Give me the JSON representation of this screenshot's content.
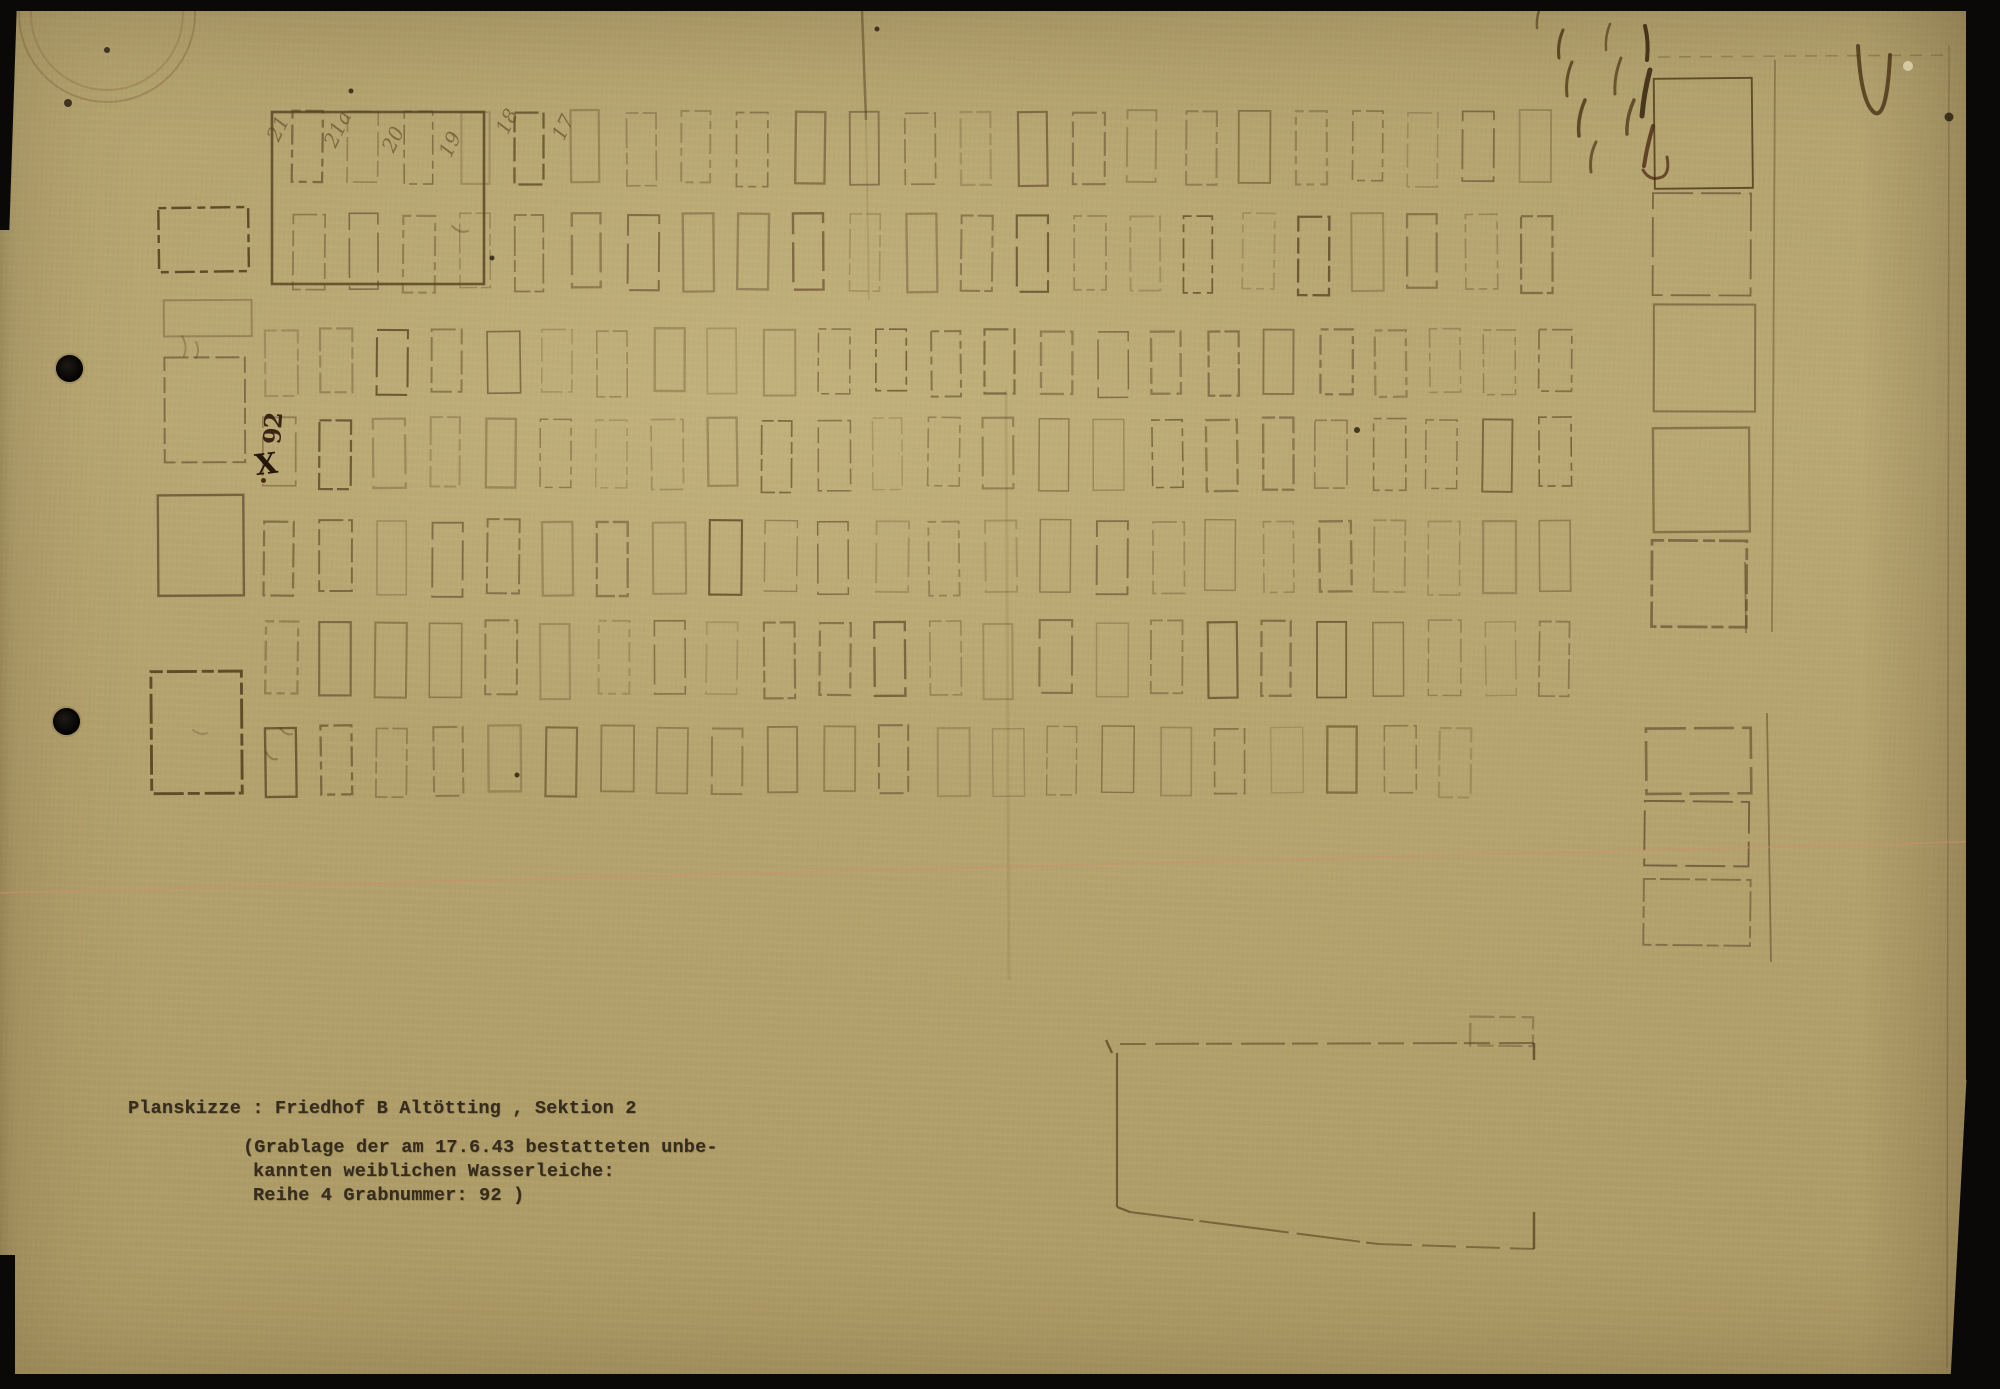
{
  "document_type": "scanned archival plan sketch",
  "caption": {
    "title": "Planskizze : Friedhof B Altötting , Sektion 2",
    "note_line1": "(Grablage der am 17.6.43 bestatteten unbe-",
    "note_line2": "kannten weiblichen Wasserleiche:",
    "note_line3": "Reihe 4 Grabnummer: 92 )"
  },
  "handwritten": {
    "grave_mark": {
      "number": "92",
      "symbol": "X"
    },
    "row_labels": [
      {
        "text": "21",
        "x": 283,
        "y": 143
      },
      {
        "text": "21a",
        "x": 340,
        "y": 149
      },
      {
        "text": "20",
        "x": 398,
        "y": 154
      },
      {
        "text": "19",
        "x": 455,
        "y": 159
      },
      {
        "text": "18",
        "x": 512,
        "y": 136
      },
      {
        "text": "17",
        "x": 568,
        "y": 142
      }
    ]
  },
  "colors": {
    "paper": "#b4a36f",
    "ink_faded": "#6b5334",
    "ink_dark": "#54401f",
    "typewriter": "#362c1e",
    "stamp": "#73552f",
    "crease_pink": "#cf8f6f",
    "scan_black": "#0a0908"
  },
  "plan": {
    "ink": "#6b5334",
    "ink_dark": "#54401f",
    "ink_alt": "#76603c",
    "grave_rows": [
      {
        "name": "row-1",
        "y": 112,
        "h": 72,
        "x0": 292,
        "pitch": 55.8,
        "cols": 23,
        "w": 30
      },
      {
        "name": "row-2",
        "y": 215,
        "h": 76,
        "x0": 292,
        "pitch": 55.8,
        "cols": 23,
        "w": 30
      },
      {
        "name": "row-3",
        "y": 330,
        "h": 64,
        "x0": 266,
        "pitch": 55.4,
        "cols": 24,
        "w": 31
      },
      {
        "name": "row-4",
        "y": 419,
        "h": 70,
        "x0": 264,
        "pitch": 55.4,
        "cols": 24,
        "w": 31
      },
      {
        "name": "row-5",
        "y": 521,
        "h": 72,
        "x0": 265,
        "pitch": 55.4,
        "cols": 24,
        "w": 31
      },
      {
        "name": "row-6",
        "y": 622,
        "h": 74,
        "x0": 265,
        "pitch": 55.4,
        "cols": 24,
        "w": 31
      },
      {
        "name": "row-7",
        "y": 727,
        "h": 67,
        "x0": 264,
        "pitch": 56.0,
        "cols": 22,
        "w": 31
      }
    ],
    "block": {
      "x": 272,
      "y": 112,
      "w": 212,
      "h": 172
    },
    "left_rects": [
      [
        158,
        208,
        88,
        62
      ],
      [
        162,
        300,
        86,
        34
      ],
      [
        164,
        358,
        82,
        106
      ],
      [
        159,
        497,
        85,
        102
      ],
      [
        153,
        673,
        89,
        120
      ]
    ],
    "right_squares": [
      [
        1656,
        78,
        97,
        112
      ],
      [
        1653,
        192,
        100,
        102
      ],
      [
        1653,
        305,
        100,
        106
      ],
      [
        1654,
        427,
        98,
        102
      ],
      [
        1650,
        541,
        95,
        87
      ],
      [
        1647,
        728,
        104,
        64
      ],
      [
        1646,
        803,
        104,
        64
      ],
      [
        1645,
        878,
        105,
        66
      ]
    ],
    "misc_rects": [
      [
        1471,
        1016,
        61,
        27
      ]
    ],
    "lines": [
      [
        1775,
        60,
        1772,
        632,
        0.4,
        1.8,
        ""
      ],
      [
        1745,
        562,
        1746,
        633,
        0.45,
        1.8,
        ""
      ],
      [
        1767,
        713,
        1771,
        962,
        0.5,
        1.8,
        ""
      ],
      [
        1949,
        45,
        1947,
        1368,
        0.28,
        1.6,
        ""
      ],
      [
        1658,
        57,
        1948,
        55,
        0.3,
        1.6,
        "12 9"
      ],
      [
        1106,
        1040,
        1112,
        1053,
        0.7,
        2.5,
        ""
      ],
      [
        1120,
        1044,
        1534,
        1043,
        0.55,
        2,
        "26 9 44 7"
      ],
      [
        1117,
        1053,
        1117,
        1207,
        0.7,
        2.2,
        ""
      ],
      [
        1117,
        1207,
        1130,
        1212,
        0.7,
        2.2,
        ""
      ],
      [
        1130,
        1212,
        1378,
        1244,
        0.6,
        2,
        "64 6 90 8"
      ],
      [
        1378,
        1244,
        1534,
        1249,
        0.55,
        2,
        "34 10"
      ],
      [
        1534,
        1043,
        1534,
        1060,
        0.75,
        2.5,
        ""
      ],
      [
        1534,
        1212,
        1534,
        1249,
        0.75,
        2.5,
        ""
      ],
      [
        862,
        10,
        866,
        120,
        0.5,
        2.5,
        ""
      ],
      [
        866,
        120,
        869,
        300,
        0.12,
        2,
        ""
      ],
      [
        1006,
        390,
        1009,
        980,
        0.1,
        3,
        ""
      ]
    ],
    "crease": {
      "x1": 0,
      "y1": 893,
      "x2": 2000,
      "y2": 841,
      "color": "#cf8f6f",
      "opacity": 0.45,
      "width": 2
    },
    "ink_marks": [
      {
        "d": "M1563,30 q-6,14 -4,28",
        "w": 3,
        "o": 0.7
      },
      {
        "d": "M1572,62 q-7,16 -5,34",
        "w": 3,
        "o": 0.65
      },
      {
        "d": "M1585,100 q-8,18 -6,36",
        "w": 3.5,
        "o": 0.7
      },
      {
        "d": "M1596,142 q-7,14 -5,30",
        "w": 3,
        "o": 0.6
      },
      {
        "d": "M1610,24 q-5,12 -4,26",
        "w": 2.5,
        "o": 0.55
      },
      {
        "d": "M1621,58 q-7,18 -6,36",
        "w": 3,
        "o": 0.6
      },
      {
        "d": "M1634,100 q-8,18 -7,34",
        "w": 3.5,
        "o": 0.65
      },
      {
        "d": "M1645,26 q4,16 2,34",
        "w": 4,
        "o": 0.8,
        "c": "#2e1c08"
      },
      {
        "d": "M1650,70 q-6,22 -8,46",
        "w": 5,
        "o": 0.8,
        "c": "#2e1c08"
      },
      {
        "d": "M1653,126 q-6,20 -9,40",
        "w": 4,
        "o": 0.75,
        "c": "#47220c"
      },
      {
        "d": "M1643,170 q7,12 19,7 q8,-4 5,-20",
        "w": 3,
        "o": 0.7,
        "c": "#47220c"
      },
      {
        "d": "M1858,46 q3,58 17,67 q12,5 15,-58",
        "w": 4,
        "o": 0.7,
        "c": "#3a2208"
      },
      {
        "d": "M1540,8 q-4,10 -3,20",
        "w": 2.5,
        "o": 0.5
      },
      {
        "d": "M452,226 q8,8 16,5",
        "w": 2,
        "o": 0.3
      },
      {
        "d": "M182,336 q6,10 2,20 M196,342 q4,8 0,16",
        "w": 2,
        "o": 0.25
      },
      {
        "d": "M280,728 q6,8 12,6 M266,752 q5,9 11,7",
        "w": 2,
        "o": 0.3
      },
      {
        "d": "M193,730 q8,6 14,3",
        "w": 2,
        "o": 0.2
      }
    ],
    "dots": [
      [
        877,
        29,
        2.5
      ],
      [
        492,
        258,
        2.5
      ],
      [
        1357,
        430,
        3
      ],
      [
        517,
        775,
        2.5
      ],
      [
        1949,
        117,
        4.5
      ],
      [
        107,
        50,
        3
      ],
      [
        68,
        103,
        4
      ],
      [
        351,
        91,
        2.5
      ]
    ],
    "white_specks": [
      [
        1908,
        66,
        5
      ]
    ],
    "stamp": {
      "cx": 107,
      "cy": 14,
      "r1": 88,
      "r2": 76,
      "color": "#73552f"
    }
  }
}
